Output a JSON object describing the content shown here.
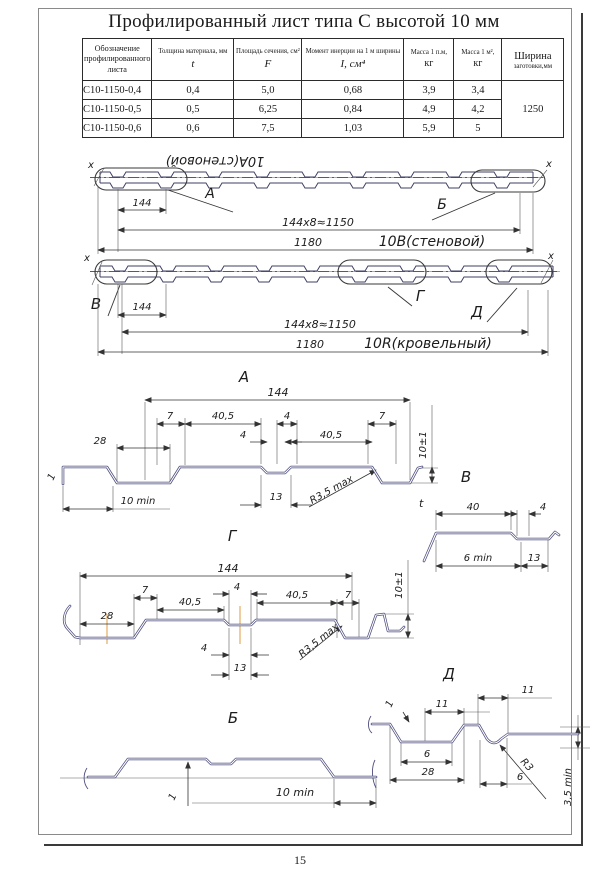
{
  "page": {
    "number": "15"
  },
  "title": "Профилированный лист типа С высотой 10 мм",
  "table": {
    "col1_header": "Обозначение профилированного листа",
    "col2_header": "Толщина материала, мм",
    "col2_symbol": "t",
    "col3_header": "Площадь сечения, см²",
    "col3_symbol": "F",
    "col4_header": "Момент инерции на 1 м ширины",
    "col4_symbol": "I, см⁴",
    "col5_header": "Масса 1 п.м,",
    "col5_symbol": "кг",
    "col6_header": "Масса 1 м²,",
    "col6_symbol": "кг",
    "col7_header_line1": "Ширина",
    "col7_header_line2": "заготовки,мм",
    "rows": [
      [
        "С10-1150-0,4",
        "0,4",
        "5,0",
        "0,68",
        "3,9",
        "3,4"
      ],
      [
        "С10-1150-0,5",
        "0,5",
        "6,25",
        "0,84",
        "4,9",
        "4,2"
      ],
      [
        "С10-1150-0,6",
        "0,6",
        "7,5",
        "1,03",
        "5,9",
        "5"
      ]
    ],
    "blank_width": "1250"
  },
  "marks": {
    "axis": "х"
  },
  "strip1": {
    "flipped_name": "10А(стеновой)",
    "callout_left": "А",
    "callout_right": "Б",
    "dim_module": "144",
    "dim_row": "144х8≈1150",
    "dim_total": "1180",
    "name": "10В(стеновой)"
  },
  "strip2": {
    "callout_left": "В",
    "callout_mid": "Г",
    "callout_right": "Д",
    "dim_module": "144",
    "dim_row": "144х8≈1150",
    "dim_total": "1180",
    "name": "10R(кровельный)"
  },
  "detail_a": {
    "label": "А",
    "dim_144": "144",
    "dim_7_left": "7",
    "dim_40_5_left": "40,5",
    "dim_4_right": "4",
    "dim_7_right": "7",
    "dim_28": "28",
    "dim_4_center": "4",
    "dim_40_5_right": "40,5",
    "dim_10_min": "10 min",
    "dim_13": "13",
    "radius_note": "R3,5 max",
    "dim_height": "10±1",
    "dim_1": "1",
    "thickness": "t"
  },
  "detail_v": {
    "label": "В",
    "dim_40": "40",
    "dim_4": "4",
    "dim_6_min": "6 min",
    "dim_13": "13"
  },
  "detail_g": {
    "label": "Г",
    "dim_144": "144",
    "dim_7_left": "7",
    "dim_40_5_left": "40,5",
    "dim_4_top": "4",
    "dim_40_5_right": "40,5",
    "dim_7_right": "7",
    "dim_28": "28",
    "dim_4_bottom": "4",
    "dim_13": "13",
    "radius_note": "R3,5 max",
    "dim_height": "10±1"
  },
  "detail_d": {
    "label": "Д",
    "dim_1": "1",
    "dim_11_left": "11",
    "dim_11_right": "11",
    "dim_6_left": "6",
    "dim_28": "28",
    "dim_6_right": "6",
    "radius_note": "R3",
    "dim_3_5_min": "3,5 min"
  },
  "detail_b": {
    "label": "Б",
    "dim_1": "1",
    "dim_10_min": "10 min"
  }
}
